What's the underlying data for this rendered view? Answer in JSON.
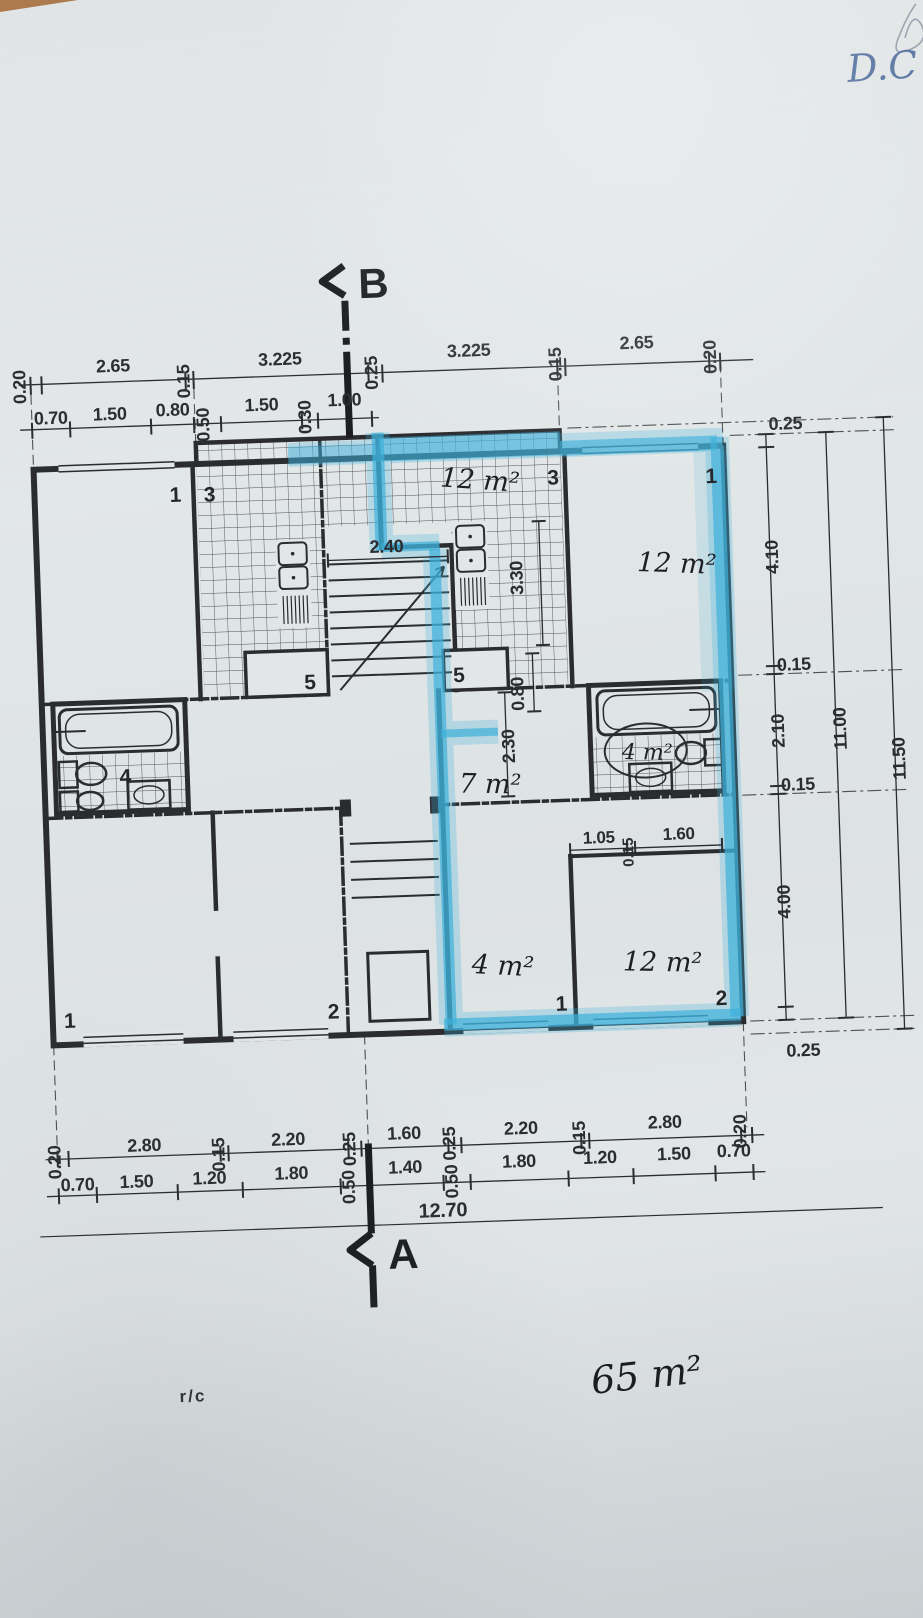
{
  "markers": {
    "top": "B",
    "bottom": "A"
  },
  "dims": {
    "top_row1": [
      "0.20",
      "2.65",
      "0.15",
      "3.225",
      "0.25",
      "3.225",
      "0.15",
      "2.65",
      "0.20"
    ],
    "top_row2": [
      "0.70",
      "1.50",
      "0.80",
      "0.50",
      "1.50",
      "0.30",
      "1.00"
    ],
    "right_inner": [
      "0.25",
      "4.10",
      "0.15",
      "2.10",
      "0.15",
      "4.00",
      "0.25"
    ],
    "right_total_inner": "11.00",
    "right_total_outer": "11.50",
    "bottom_row1": [
      "0.20",
      "2.80",
      "0.15",
      "2.20",
      "0.25",
      "1.60",
      "0.25",
      "2.20",
      "0.15",
      "2.80",
      "0.20"
    ],
    "bottom_row2": [
      "0.70",
      "1.50",
      "1.20",
      "1.80",
      "0.50",
      "1.40",
      "0.50",
      "1.80",
      "1.20",
      "1.50",
      "0.70"
    ],
    "bottom_total": "12.70",
    "internal": {
      "stair_width": "2.40",
      "kitchen_depth": "3.30",
      "pass_width": "0.80",
      "hall_depth": "2.30",
      "wall_seg_a": "1.05",
      "wall_seg_b": "0.15",
      "wall_seg_c": "1.60"
    }
  },
  "room_numbers": {
    "upper_left_room": "1",
    "upper_left_kitchen": "3",
    "upper_left_store": "5",
    "upper_right_kitchen": "3",
    "upper_right_store": "5",
    "upper_right_room": "1",
    "left_bathroom": "4",
    "lower_left_room": "1",
    "lower_left_room2": "2",
    "lower_right_hall": "1",
    "lower_right_room": "2"
  },
  "areas": {
    "upper_kitchen": "12 m²",
    "upper_right_room": "12 m²",
    "right_bathroom": "4 m²",
    "mid_hall": "7 m²",
    "lower_hall": "4 m²",
    "lower_right_room": "12 m²",
    "apartment_total": "65 m²"
  },
  "annotations": {
    "floor_label": "r/c",
    "initials": "D.C"
  },
  "colors": {
    "paper": "#dfe4e6",
    "ink": "#2b2c30",
    "highlighter": "#3fb0da",
    "pen_blue": "#51709f",
    "paper_edge_under": "#b07a48"
  }
}
